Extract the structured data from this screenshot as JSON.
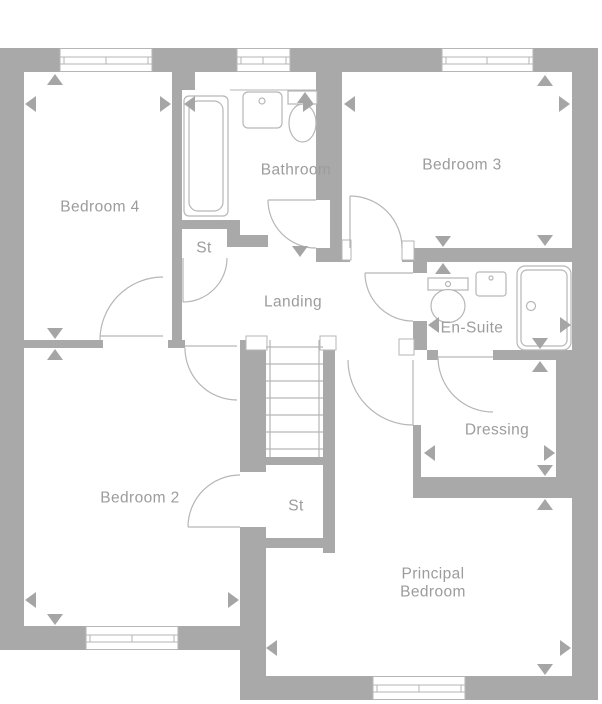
{
  "plan": {
    "title": "First floor plan",
    "rooms": {
      "bedroom4": {
        "label": "Bedroom 4"
      },
      "bathroom": {
        "label": "Bathroom"
      },
      "bedroom3": {
        "label": "Bedroom 3"
      },
      "landing": {
        "label": "Landing"
      },
      "storage_upper": {
        "label": "St"
      },
      "ensuite": {
        "label": "En-Suite"
      },
      "dressing": {
        "label": "Dressing"
      },
      "bedroom2": {
        "label": "Bedroom 2"
      },
      "storage_lower": {
        "label": "St"
      },
      "principal": {
        "line1": "Principal",
        "line2": "Bedroom"
      }
    },
    "fixtures": {
      "bathroom": [
        "bath",
        "washbasin",
        "wc"
      ],
      "ensuite": [
        "wc",
        "washbasin",
        "shower"
      ],
      "stairwell": [
        "staircase"
      ]
    },
    "window_count": 5,
    "colors": {
      "wall": "#a9a9a9",
      "line": "#b6b6b6",
      "text": "#9c9c9c",
      "marker": "#a5a5a5",
      "background": "#ffffff"
    }
  }
}
